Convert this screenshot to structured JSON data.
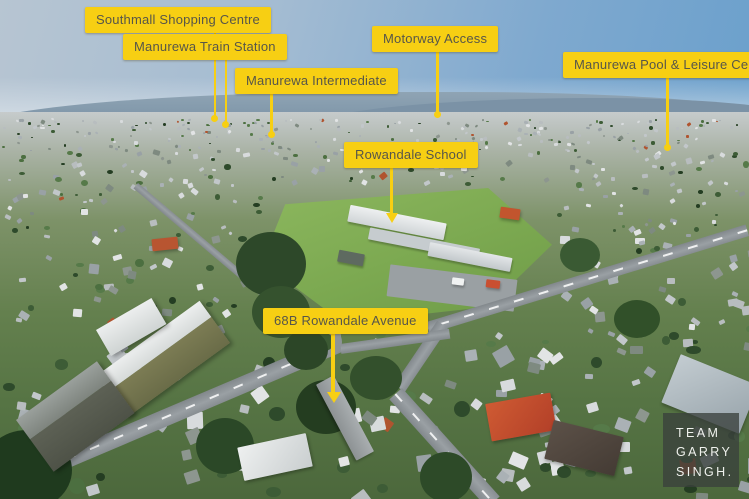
{
  "callouts": [
    {
      "text": "Southmall Shopping Centre"
    },
    {
      "text": "Manurewa Train Station"
    },
    {
      "text": "Manurewa Intermediate"
    },
    {
      "text": "Motorway Access"
    },
    {
      "text": "Manurewa Pool & Leisure Centre"
    },
    {
      "text": "Rowandale School"
    },
    {
      "text": "68B Rowandale Avenue"
    }
  ],
  "watermark": {
    "lines": [
      "TEAM",
      "GARRY",
      "SINGH."
    ]
  },
  "colors": {
    "label_background": "#F7CF13",
    "label_text": "#57564A",
    "leader_line": "#F7CF13",
    "watermark_background": "rgba(58,64,60,0.78)",
    "watermark_text": "#EFF1ED"
  }
}
